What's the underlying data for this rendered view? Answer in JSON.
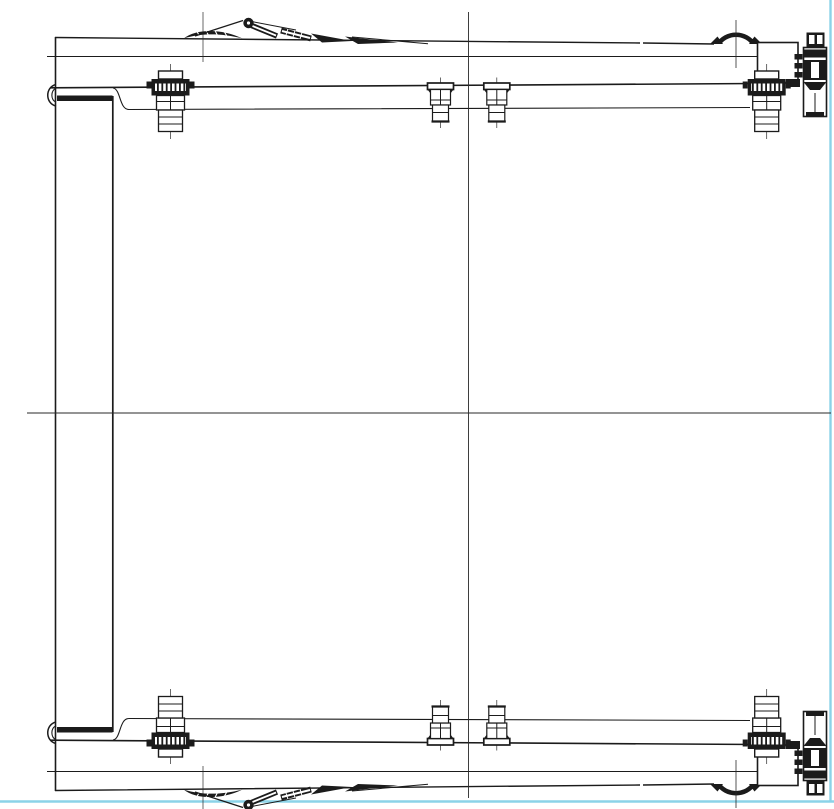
{
  "drawing": {
    "colors": {
      "background": "#ffffff",
      "line": "#1b1b1b",
      "accent": "#8bd3e8"
    },
    "components": {
      "canvas": "cad-top-view-technical-drawing",
      "frame": "deck-outline",
      "cross_member": "left-cross-member-column",
      "crossbeam": "upper-and-lower-crossbeams",
      "bracket_large": "clamp-bracket-large",
      "bracket_small": "stanchion-socket-bracket",
      "wheel": "wheel-arc",
      "corner_box": "corner-box",
      "lock": "corner-lock-assembly",
      "linkage": "lever-linkage-mechanism",
      "axis_vertical": "vertical-center-axis",
      "axis_horizontal": "horizontal-center-axis",
      "sheet_border_right": "sheet-border-right",
      "sheet_border_bottom": "sheet-border-bottom"
    }
  }
}
